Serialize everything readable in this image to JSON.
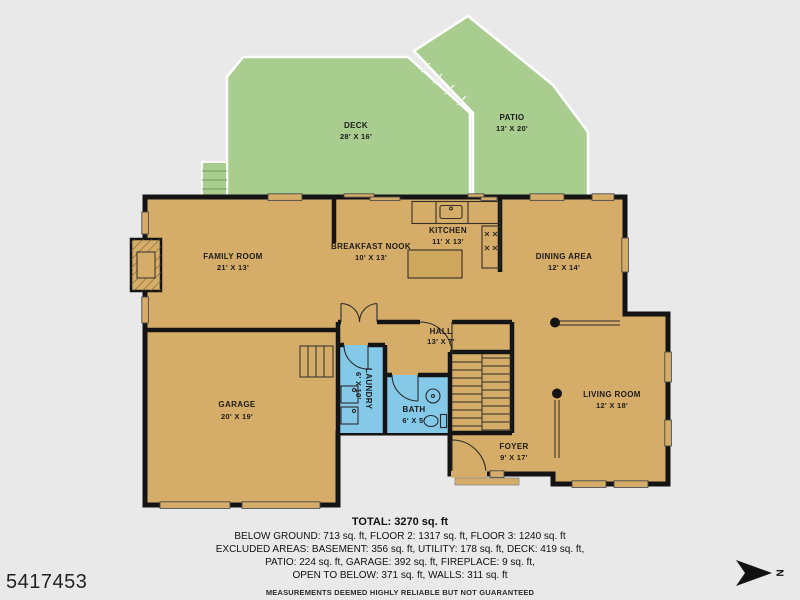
{
  "listing": {
    "mls_number": "5417453"
  },
  "compass": {
    "letter": "N"
  },
  "colors": {
    "background": "#e9e9e9",
    "floor_fill": "#d5ad68",
    "outdoor_fill": "#a8cd8f",
    "wet_room_fill": "#85c9e9",
    "wall": "#141414",
    "outline": "#ffffff"
  },
  "outdoor": {
    "deck": {
      "name": "DECK",
      "dims": "28' X 16'"
    },
    "patio": {
      "name": "PATIO",
      "dims": "13' X 20'"
    }
  },
  "rooms": {
    "family": {
      "name": "FAMILY ROOM",
      "dims": "21' X 13'"
    },
    "nook": {
      "name": "BREAKFAST NOOK",
      "dims": "10' X 13'"
    },
    "kitchen": {
      "name": "KITCHEN",
      "dims": "11' X 13'"
    },
    "dining": {
      "name": "DINING AREA",
      "dims": "12' X 14'"
    },
    "hall": {
      "name": "HALL",
      "dims": "13' X 7'"
    },
    "garage": {
      "name": "GARAGE",
      "dims": "20' X 19'"
    },
    "laundry": {
      "name": "LAUNDRY",
      "dims": "6' X 10'"
    },
    "bath": {
      "name": "BATH",
      "dims": "6' X 5'"
    },
    "living": {
      "name": "LIVING ROOM",
      "dims": "12' X 18'"
    },
    "foyer": {
      "name": "FOYER",
      "dims": "9' X 17'"
    }
  },
  "footer": {
    "total": "TOTAL: 3270 sq. ft",
    "line1": "BELOW GROUND: 713 sq. ft, FLOOR 2: 1317 sq. ft, FLOOR 3: 1240 sq. ft",
    "line2": "EXCLUDED AREAS: BASEMENT: 356 sq. ft, UTILITY: 178 sq. ft, DECK: 419 sq. ft,",
    "line3": "PATIO: 224 sq. ft, GARAGE: 392 sq. ft, FIREPLACE: 9 sq. ft,",
    "line4": "OPEN TO BELOW: 371 sq. ft, WALLS: 311 sq. ft",
    "disclaimer": "MEASUREMENTS DEEMED HIGHLY RELIABLE BUT NOT GUARANTEED"
  }
}
